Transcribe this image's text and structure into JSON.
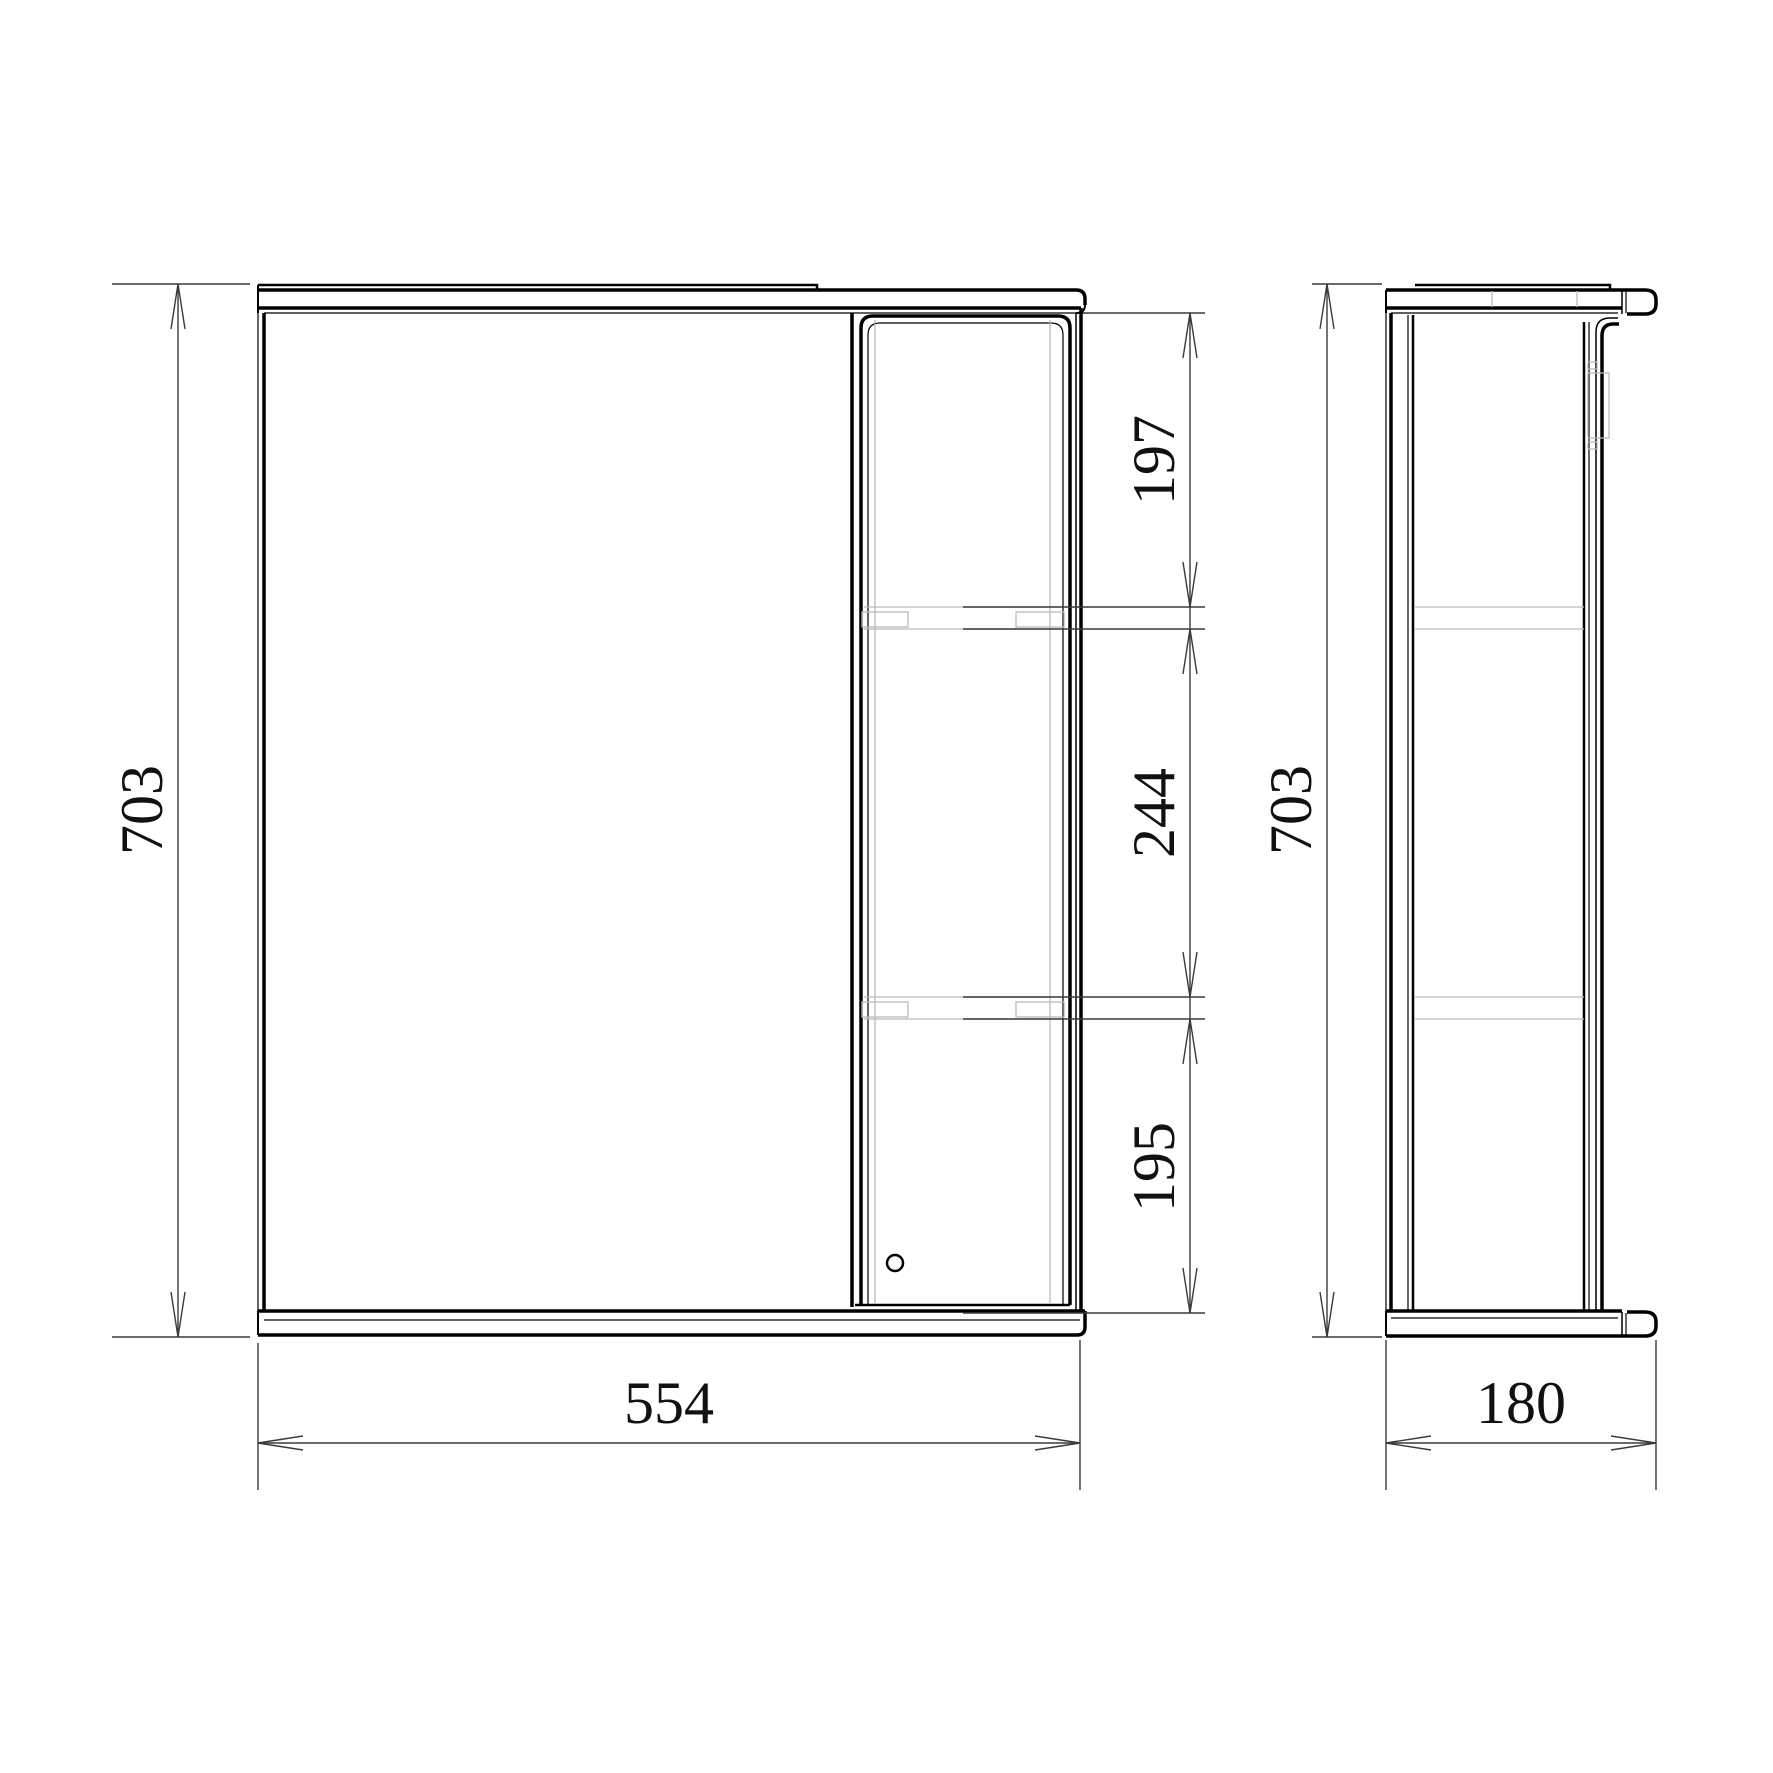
{
  "drawing": {
    "type": "furniture-technical-drawing",
    "subject": "mirror-cabinet-with-side-shelf-column",
    "front_view": {
      "overall": {
        "height_mm": "703",
        "width_mm": "554"
      },
      "shelf_spacing_mm": [
        "197",
        "244",
        "195"
      ]
    },
    "side_view": {
      "overall": {
        "height_mm": "703",
        "depth_mm": "180"
      }
    },
    "colors": {
      "line": "#000000",
      "dim": "#3a3a3a",
      "hidden": "#b9b9b9",
      "background": "#ffffff",
      "text": "#111111"
    }
  }
}
